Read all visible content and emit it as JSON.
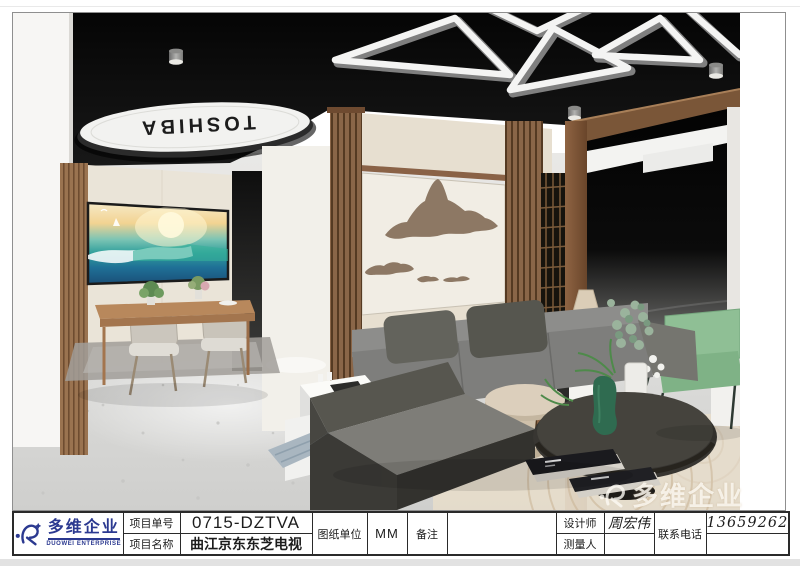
{
  "render": {
    "ceiling_brand": "TOSHIBA",
    "watermark_text": "多维企业"
  },
  "title_block": {
    "company": {
      "name_cn": "多维企业",
      "name_en": "DUOWEI ENTERPRISE"
    },
    "project_no_label": "项目单号",
    "project_no_value": "0715-DZTVA",
    "project_name_label": "项目名称",
    "project_name_value": "曲江京东东芝电视",
    "drawing_unit_label": "图纸单位",
    "drawing_unit_value": "MM",
    "remark_label": "备注",
    "remark_value": "",
    "designer_label": "设计师",
    "designer_value": "周宏伟",
    "surveyor_label": "测量人",
    "surveyor_value": "",
    "phone_label": "联系电话",
    "phone_value": "13659262305"
  },
  "colors": {
    "logo_blue": "#2b3990",
    "ceiling_black": "#0b0b0b",
    "wood_brown": "#8a6246",
    "sofa_gray": "#7e7e7c",
    "accent_green": "#8fbf95",
    "cream_panel": "#f1ede4",
    "mountain_brown": "#8d7864"
  }
}
